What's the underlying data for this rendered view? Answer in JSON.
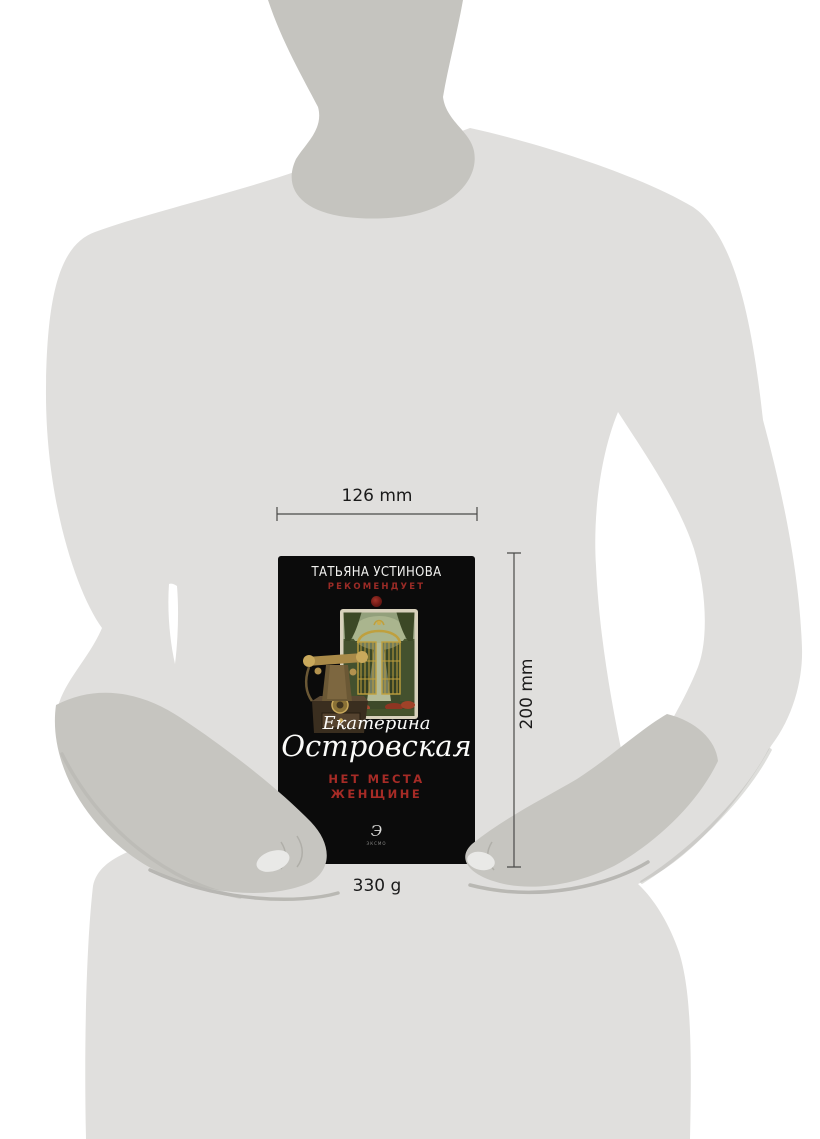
{
  "annotations": {
    "width": "126 mm",
    "height": "200 mm",
    "weight": "330 g"
  },
  "book_cover": {
    "series_author": "ТАТЬЯНА УСТИНОВА",
    "series_tagline": "РЕКОМЕНДУЕТ",
    "author_first_name": "Екатерина",
    "author_last_name": "Островская",
    "title_line1": "НЕТ МЕСТА",
    "title_line2": "ЖЕНЩИНЕ",
    "publisher_logo_glyph": "Э",
    "publisher_name": "ЭКСМО"
  },
  "colors": {
    "background": "#ffffff",
    "body_silhouette": "#e0dfdd",
    "neck_silhouette": "#c5c4bf",
    "arm_silhouette": "#c6c5c0",
    "arm_shadow": "#b2b1ac",
    "fingertip_highlight": "#e9e9e7",
    "book_cover_black": "#0b0b0b",
    "title_red": "#a62b26",
    "recommend_red": "#9b2b26",
    "dimension_line": "#4a4a48",
    "label_text": "#1b1b1b"
  }
}
